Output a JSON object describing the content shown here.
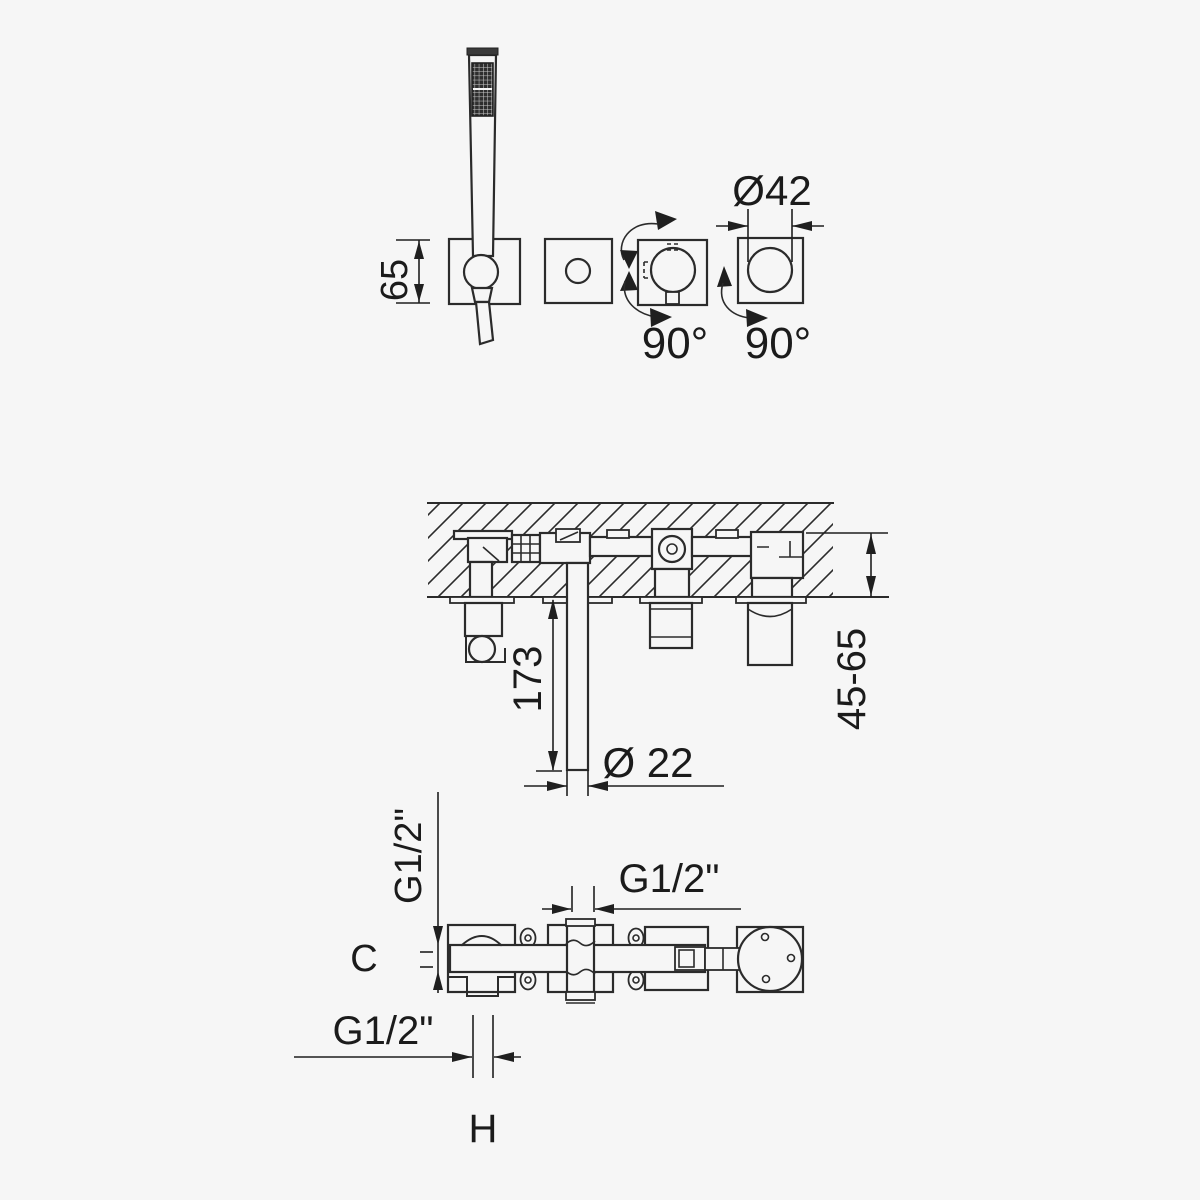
{
  "colors": {
    "background": "#f6f6f6",
    "line": "#2b2b2b",
    "text": "#1b1b1b"
  },
  "front_view": {
    "dim_height": "65",
    "dim_diameter": "Ø42",
    "rotation_left": "90°",
    "rotation_right": "90°"
  },
  "section_view": {
    "dim_spout_length": "173",
    "dim_spout_diameter": "Ø 22",
    "dim_wall_depth": "45-65"
  },
  "plan_view": {
    "dim_thread_left": "G1/2\"",
    "dim_thread_center": "G1/2\"",
    "dim_thread_bottom": "G1/2\"",
    "dim_center_distance": "C",
    "dim_holder_width": "H"
  }
}
